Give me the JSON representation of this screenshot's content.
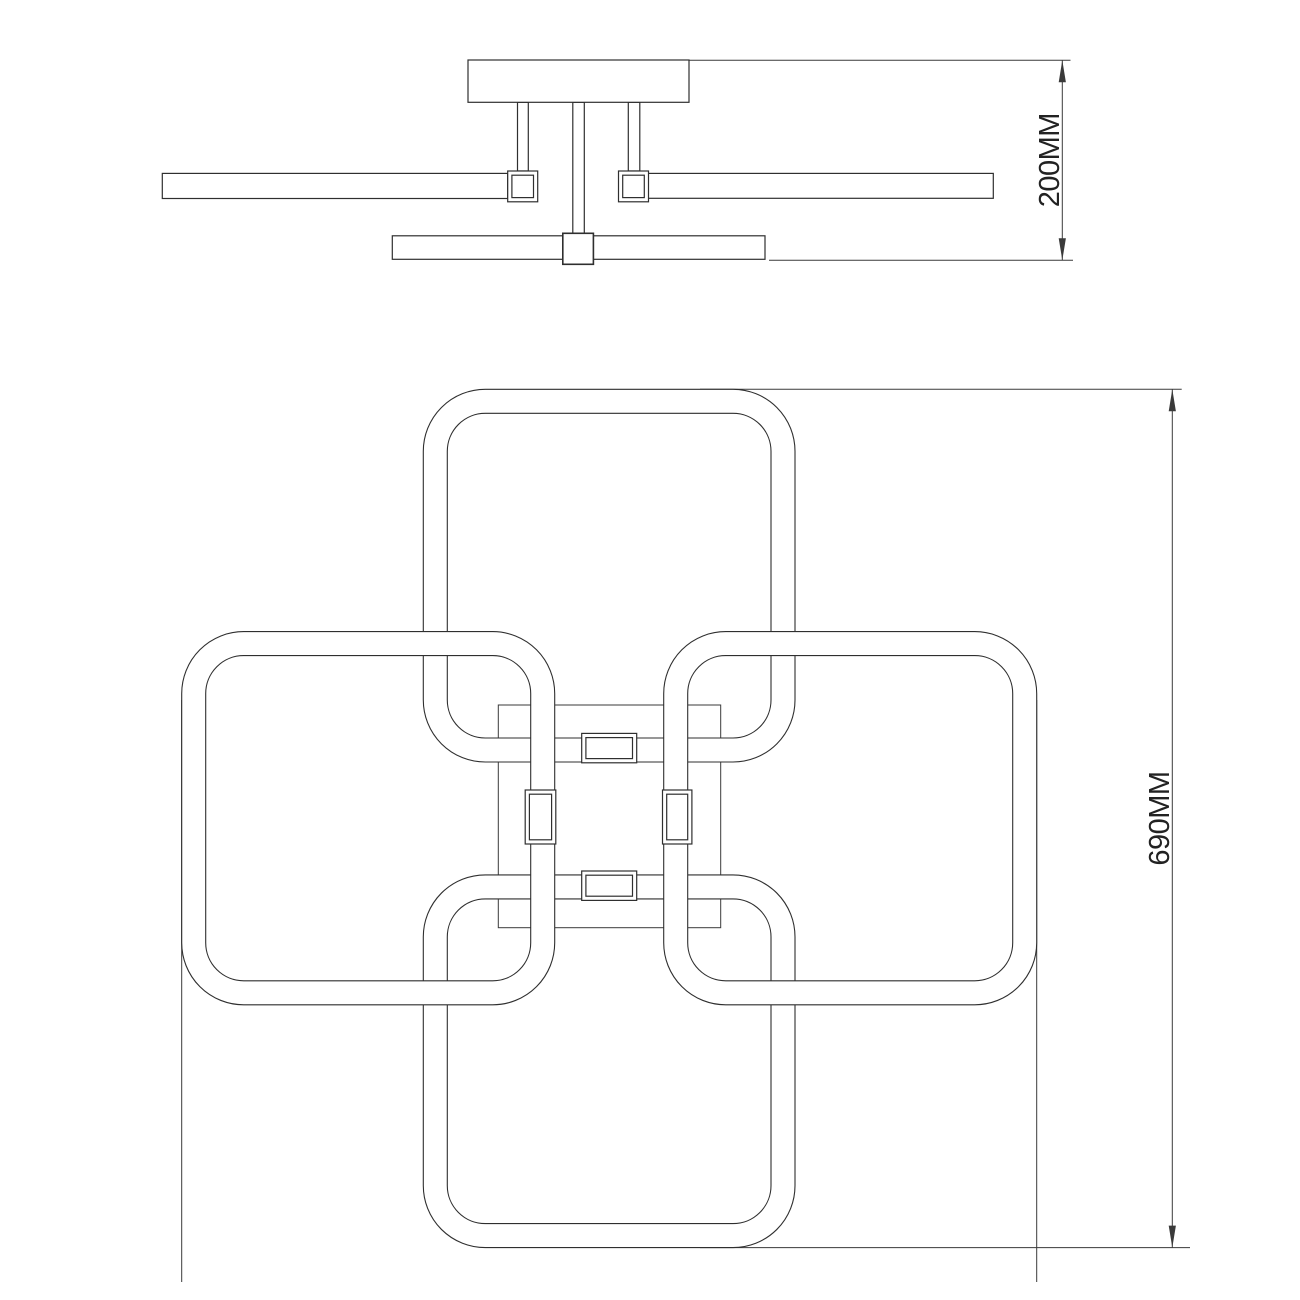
{
  "document": {
    "kind": "ceiling-lamp technical dimension drawing",
    "background": "#ffffff"
  },
  "labels": {
    "side_dimension": "200MM",
    "plan_dimension": "690MM"
  },
  "colors": {
    "line": "#2f2f2f",
    "thin_line": "#3a3a3a",
    "fill": "#ffffff",
    "text": "#222222"
  },
  "dimensions_mm": {
    "height": 200,
    "width": 690
  },
  "geometry": {
    "side_view": {
      "canopy": [
        468,
        60,
        221,
        42.3
      ],
      "rods": [
        {
          "name": "left-rod",
          "r": [
            517.5,
            102.3,
            10.8,
            68.7
          ]
        },
        {
          "name": "center-rod",
          "r": [
            572.8,
            102.3,
            11.5,
            131.0
          ]
        },
        {
          "name": "right-rod",
          "r": [
            628.3,
            102.3,
            11.5,
            68.7
          ]
        }
      ],
      "bars": [
        {
          "name": "left-arm-bar",
          "r": [
            162.3,
            173.4,
            345.4,
            25.1
          ]
        },
        {
          "name": "right-arm-bar",
          "r": [
            648.3,
            173.4,
            345.0,
            24.9
          ]
        },
        {
          "name": "lower-arm-bar",
          "r": [
            392.3,
            235.8,
            372.7,
            23.5
          ]
        }
      ],
      "connectors": [
        {
          "name": "left-connector",
          "outer": [
            507.7,
            171.0,
            30.0,
            30.8
          ],
          "inner": [
            511.9,
            175.2,
            21.6,
            22.4
          ]
        },
        {
          "name": "right-connector",
          "outer": [
            618.5,
            171.0,
            30.0,
            30.8
          ],
          "inner": [
            622.7,
            175.2,
            21.6,
            22.4
          ]
        },
        {
          "name": "center-connector",
          "outer": [
            562.8,
            233.3,
            30.6,
            31.0
          ],
          "inner": null
        }
      ],
      "extension_lines": [
        [
          689.0,
          60.3,
          1070.5,
          60.3
        ],
        [
          769.0,
          260.2,
          1073.0,
          260.2
        ]
      ],
      "dimension_line": [
        1062.3,
        60.3,
        1062.3,
        260.2
      ],
      "arrows": [
        {
          "tip": [
            1062.3,
            60.3
          ],
          "dir": "up"
        },
        {
          "tip": [
            1062.3,
            260.2
          ],
          "dir": "down"
        }
      ],
      "label_anchor": {
        "x": 1059,
        "y": 160.2
      }
    },
    "plan_view": {
      "frame": [
        498.3,
        705.0,
        222.4,
        222.7
      ],
      "rings": [
        {
          "name": "top-ring",
          "r": [
            423.3,
            389.3,
            371.7,
            372.7
          ]
        },
        {
          "name": "bottom-ring",
          "r": [
            423.3,
            874.9,
            371.7,
            372.7
          ]
        },
        {
          "name": "left-ring",
          "r": [
            181.7,
            631.6,
            373.0,
            373.2
          ]
        },
        {
          "name": "right-ring",
          "r": [
            663.7,
            631.6,
            373.0,
            373.2
          ]
        }
      ],
      "tube_width": 24,
      "corner_radius_outer": 62,
      "corner_radius_inner": 38,
      "clips": [
        {
          "name": "top-clip",
          "outer": [
            581.7,
            733.4,
            55.0,
            29.4
          ],
          "inner": [
            585.9,
            737.6,
            46.6,
            21.0
          ]
        },
        {
          "name": "bottom-clip",
          "outer": [
            581.7,
            871.0,
            55.0,
            29.4
          ],
          "inner": [
            585.9,
            875.2,
            46.6,
            21.0
          ]
        },
        {
          "name": "left-clip",
          "outer": [
            525.2,
            790.0,
            30.6,
            54.0
          ],
          "inner": [
            529.4,
            794.2,
            22.2,
            45.6
          ]
        },
        {
          "name": "right-clip",
          "outer": [
            662.5,
            790.0,
            29.4,
            54.0
          ],
          "inner": [
            666.7,
            794.2,
            21.0,
            45.6
          ]
        }
      ],
      "extension_lines": [
        [
          181.7,
          700.0,
          181.7,
          1282.0
        ],
        [
          1036.7,
          700.0,
          1036.7,
          1282.0
        ],
        [
          700.0,
          389.3,
          1181.7,
          389.3
        ],
        [
          700.0,
          1247.6,
          1190.0,
          1247.6
        ]
      ],
      "dimension_line": [
        1172.3,
        389.3,
        1172.3,
        1247.6
      ],
      "arrows": [
        {
          "tip": [
            1172.3,
            389.3
          ],
          "dir": "up"
        },
        {
          "tip": [
            1172.3,
            1247.6
          ],
          "dir": "down"
        }
      ],
      "label_anchor": {
        "x": 1169,
        "y": 818.5
      }
    }
  }
}
